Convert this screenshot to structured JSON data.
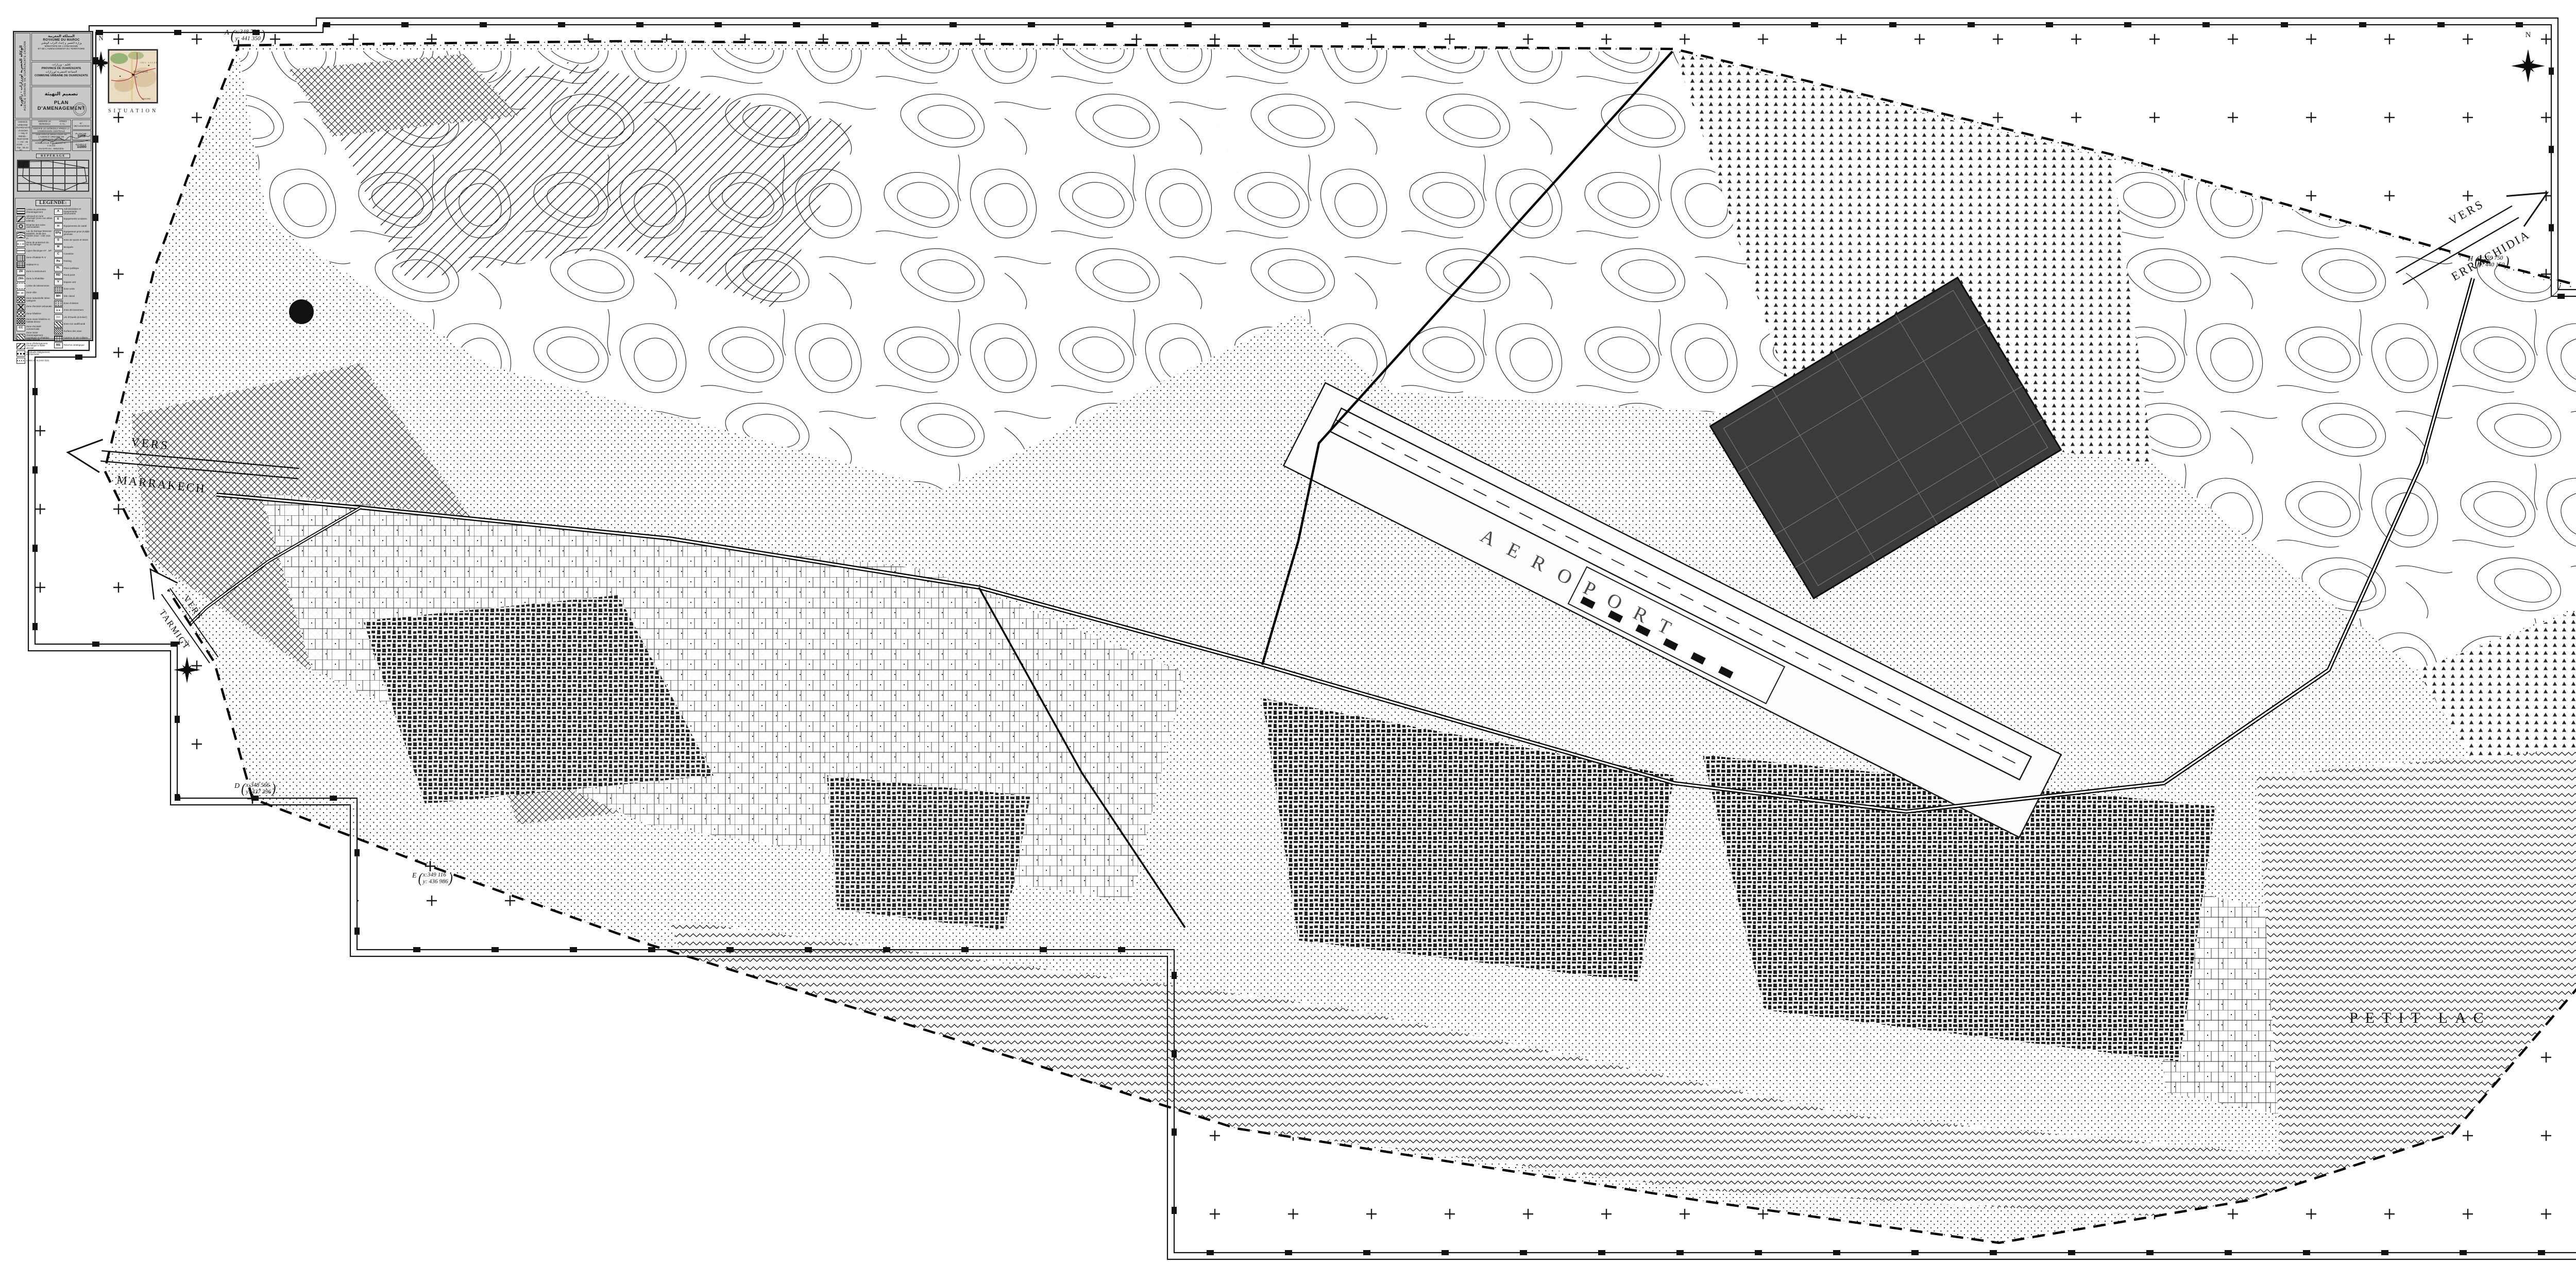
{
  "sheet": {
    "background": "#ffffff",
    "ink": "#141414"
  },
  "title_block": {
    "side_ar": "الوكالة الحضرية لورزازات - زاكورة",
    "side_fr": "AGENCE URBAINE DE OUARZAZATE-ZAGORA",
    "kingdom_ar": "المملكة المغربية",
    "kingdom_fr": "ROYAUME DU MAROC",
    "ministry_ar": "وزارة التعمير و إعداد التراب الوطني",
    "ministry_fr_1": "MINISTERE DE L'URBANISME",
    "ministry_fr_2": "ET DE L'AMENAGEMENT DU TERRITOIRE",
    "province_ar": "إقليم : ورزازات",
    "province_fr": "PROVINCE DE OUARZAZATE",
    "commune_ar": "الجماعة الحضرية لورزازات",
    "commune_fr": "COMMUNE URBAINE DE OUARZAZATE",
    "doc_ar": "تصميم التهيئة",
    "doc_fr": "PLAN D'AMENAGEMENT",
    "office_lines": "AGENCE URBAINE OUARZAZATE - ZAGORA — Hay Al Wahda - Ouarzazate — Tél : 05 24 88 .. .. — Fax : 05 24 88 .. ..",
    "rev1a": "MODIFIE LE 09/05/2013",
    "rev1b": "APRES C.T.L.",
    "rev2": "MODIFIE LE 04/09/2014 APRES LA COMMISSION CENTRALE",
    "rev3": "VISE PAR LE DIRECTEUR DE L'AGENCE URBAINE DE OUARZAZATE-ZAGORA",
    "hom1": "HOMOLOGUE PAR DECRET N° : 2.15.112",
    "hom2": "EN DATE DU : 09/04/2015",
    "hom3": "B.O N° : 6354 du 18/06/2015",
    "num_label": "N° : 08/AUOZ/2015",
    "planche_label": "PLANCHE :",
    "planche_value": "01/06",
    "echelle_label": "ECHELLE :",
    "echelle_value": "1/2000",
    "reperage_title": "REPÉRAGE",
    "reperage_cols": 6,
    "reperage_rows": 4,
    "legend_title": "LEGENDE:"
  },
  "situation": {
    "title": "SITUATION",
    "city": "OUARZAZATE",
    "city2": "ZAGORA",
    "region": "JBEL SAGHRO"
  },
  "legend": {
    "left": [
      {
        "swatch": "dline",
        "label": "Limite du périmètre d'aménagement"
      },
      {
        "swatch": "airport",
        "label": "Aéroport et zone d'accueil (zone non altius tollendi)"
      },
      {
        "swatch": "circle",
        "label": "Emprise des voies carrossables"
      },
      {
        "swatch": "waves",
        "label": "Lac du barrage Mansour Eddahbi, limite des hautes eaux : cote 1111 m"
      },
      {
        "swatch": "dashdot",
        "label": "Zone de protection du lac du barrage"
      },
      {
        "swatch": "line",
        "label": "Ligne électrique HT . MT"
      },
      {
        "swatch": "vhatch",
        "label": "Zone d'habitat R+3"
      },
      {
        "swatch": "grid",
        "label": "Habitat R+2"
      },
      {
        "swatch": "letter",
        "letter": "ZR",
        "label": "Zone à restructurer"
      },
      {
        "swatch": "letter",
        "letter": "ZRh",
        "label": "Zone à réhabiliter"
      },
      {
        "swatch": "dashed",
        "label": "Limite de lotissements"
      },
      {
        "swatch": "dash",
        "label": "Zone Villa"
      },
      {
        "swatch": "diagsq",
        "label": "Zone Industrielle 3ème catégorie"
      },
      {
        "swatch": "x1",
        "label": "Zone d'activité artisanale"
      },
      {
        "swatch": "x2",
        "label": "Zone hôtelière"
      },
      {
        "swatch": "x3",
        "label": "Zone mixte hôtelière et habitat dense"
      },
      {
        "swatch": "letter",
        "letter": "CC",
        "label": "Zone d'activité commerciale"
      },
      {
        "swatch": "diag",
        "label": "Zone mixte d'aménagement touristique et d'habitat faible densité"
      },
      {
        "swatch": "diag2",
        "label": "Zone d'hébergement touristique à faible densité"
      },
      {
        "swatch": "sqrow",
        "label": "Servitude d'alignement architectural"
      },
      {
        "swatch": "dotline",
        "label": "Limite de la zone 1111"
      }
    ],
    "right": [
      {
        "swatch": "letter",
        "letter": "A",
        "label": "Administration et équipements structurants"
      },
      {
        "swatch": "letter",
        "letter": "E",
        "label": "Équipements scolaires"
      },
      {
        "swatch": "letter",
        "letter": "H",
        "label": "Équipements de santé"
      },
      {
        "swatch": "letter",
        "letter": "EPg",
        "label": "Équipement privé d'utilité générale"
      },
      {
        "swatch": "letter",
        "letter": "S",
        "label": "Zone de sports et loisirs"
      },
      {
        "swatch": "letter",
        "letter": "M",
        "label": "Mosquée"
      },
      {
        "swatch": "letter",
        "letter": "C",
        "label": "Cimetière"
      },
      {
        "swatch": "letter",
        "letter": "Pa",
        "label": "Parking"
      },
      {
        "swatch": "letter",
        "letter": "PL",
        "label": "Place publique"
      },
      {
        "swatch": "letter",
        "letter": "RD",
        "label": "Rond point"
      },
      {
        "swatch": "letter",
        "letter": "V",
        "label": "Espace vert"
      },
      {
        "swatch": "dots",
        "label": "Zone verte"
      },
      {
        "swatch": "letter",
        "letter": "MH",
        "label": "Site classé"
      },
      {
        "swatch": "dashrow",
        "label": "Zone d'oliviers"
      },
      {
        "swatch": "tri",
        "label": "Zone de boisement"
      },
      {
        "swatch": "chev",
        "label": "Lits d'Oueds (à boiser)"
      },
      {
        "swatch": "diag",
        "label": "Zone non aedificandi"
      },
      {
        "swatch": "hatch",
        "label": "Surface des eaux"
      },
      {
        "swatch": "sqgrid",
        "label": "Caserne et site militaire"
      },
      {
        "swatch": "letter",
        "letter": "RS",
        "label": "Réserve stratégique"
      }
    ]
  },
  "map": {
    "north": "N",
    "labels": {
      "petit_lac": "PETIT LAC",
      "aeroport": "AEROPORT"
    },
    "edges": {
      "marrakech1": "VERS",
      "marrakech2": "MARRAKECH",
      "errachidia1": "VERS",
      "errachidia2": "ERRACHIDIA",
      "tarmigt1": "VERS",
      "tarmigt2": "TARMIGT"
    },
    "points": {
      "A": {
        "name": "A",
        "x": "x:348 750",
        "y": "y: 441 350"
      },
      "D": {
        "name": "D",
        "x": "x:348 566",
        "y": "y: 437 396"
      },
      "E": {
        "name": "E",
        "x": "x:349 116",
        "y": "y: 436 986"
      },
      "G": {
        "name": "G",
        "x": "x:360 850",
        "y": "y: 437 250"
      },
      "H": {
        "name": "H",
        "x": "x:359 750",
        "y": "y: 440 150"
      }
    }
  }
}
